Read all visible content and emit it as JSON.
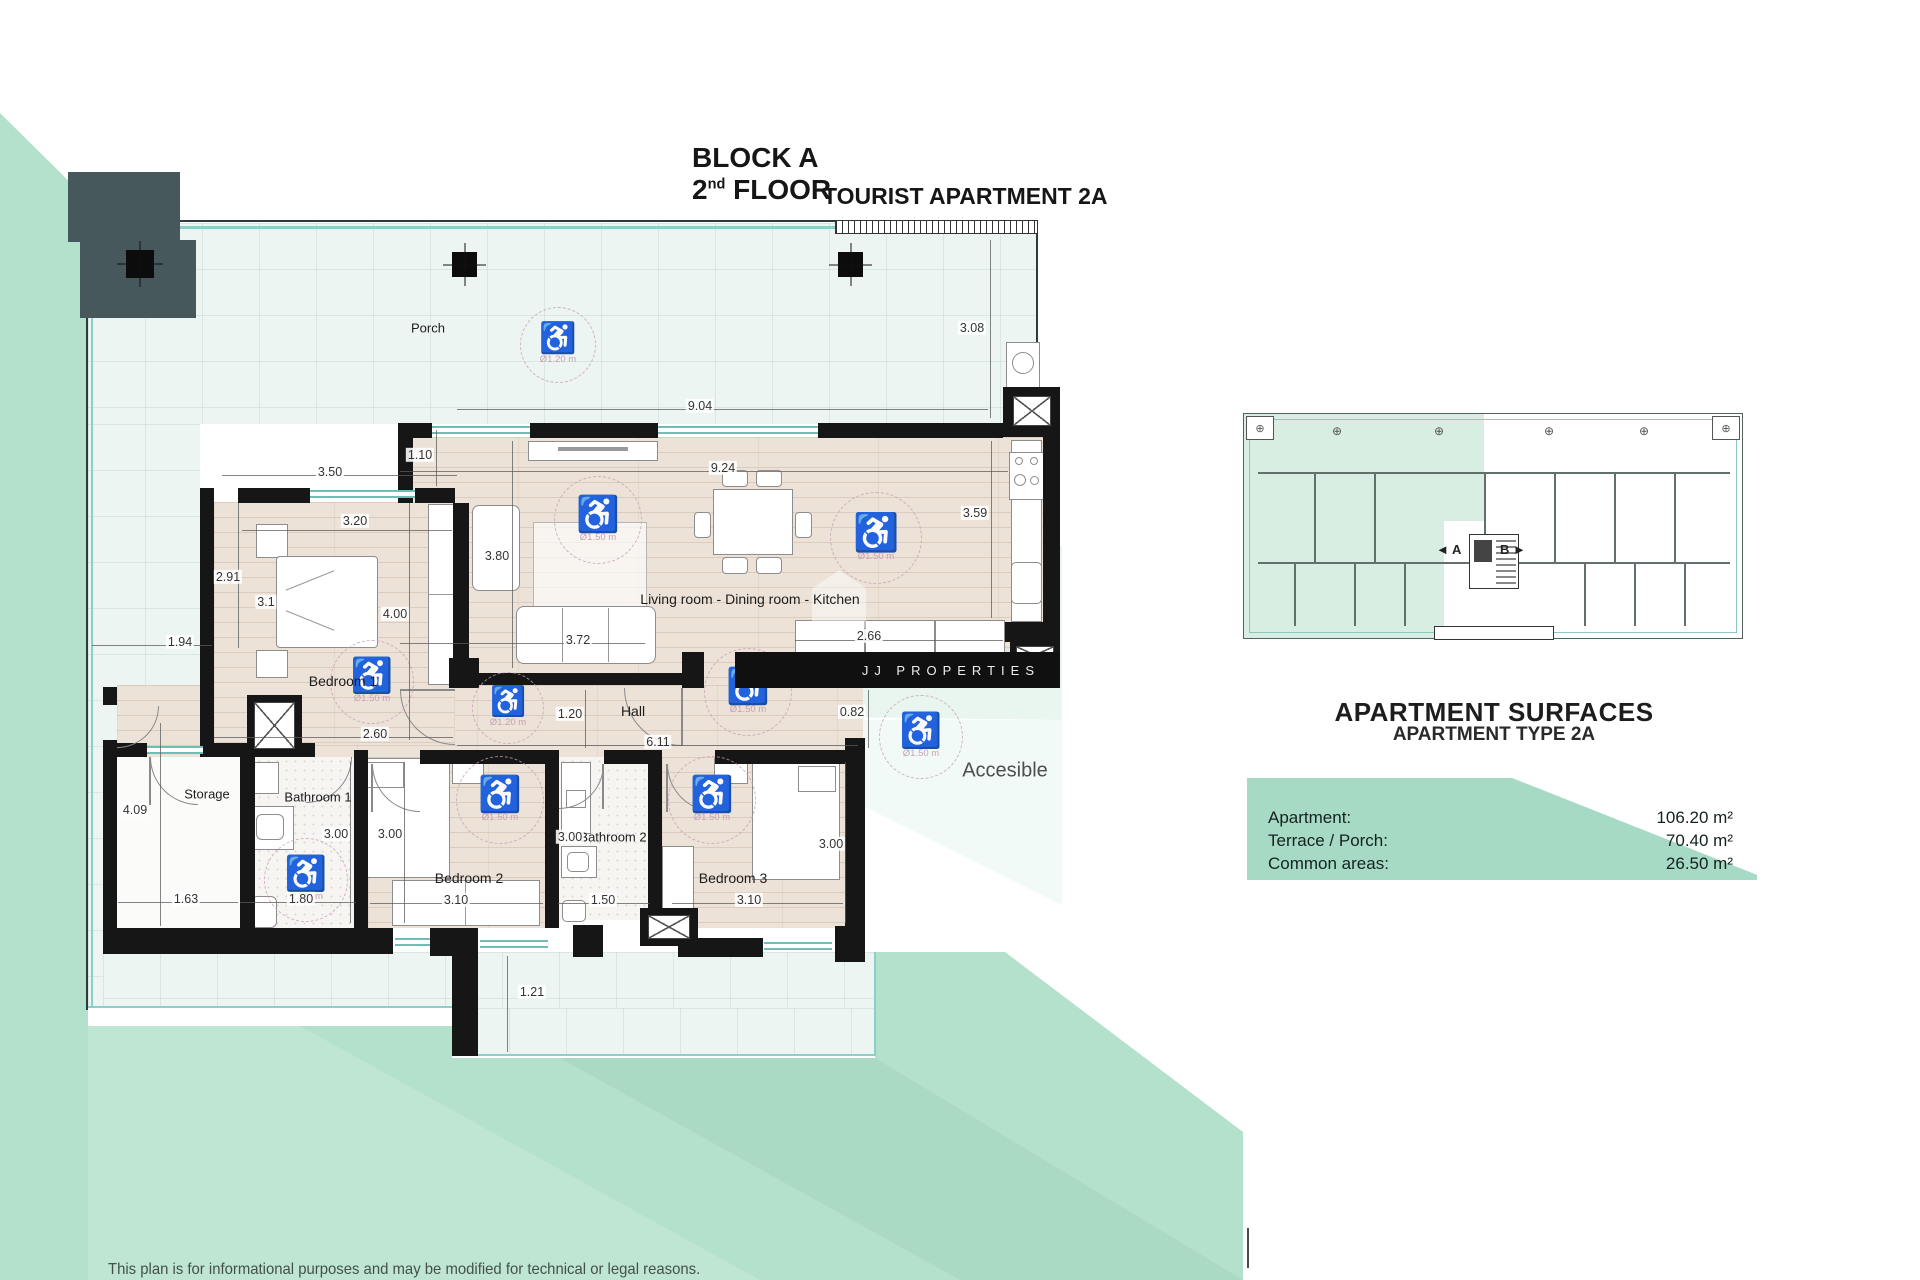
{
  "header": {
    "block_label": "BLOCK A",
    "floor_number": "2",
    "floor_ordinal": "nd",
    "floor_label": "FLOOR",
    "apartment_label": "TOURIST APARTMENT 2A"
  },
  "watermark": {
    "brand": "JJ PROPERTIES"
  },
  "plan": {
    "room_labels": [
      {
        "text": "Porch",
        "x": 428,
        "y": 328,
        "size": 13
      },
      {
        "text": "Living room - Dining room - Kitchen",
        "x": 750,
        "y": 599,
        "size": 14
      },
      {
        "text": "Bedroom 1",
        "x": 343,
        "y": 681,
        "size": 14
      },
      {
        "text": "Hall",
        "x": 633,
        "y": 711,
        "size": 14
      },
      {
        "text": "Storage",
        "x": 207,
        "y": 794,
        "size": 13
      },
      {
        "text": "Bathroom 1",
        "x": 318,
        "y": 797,
        "size": 13
      },
      {
        "text": "Bathroom 2",
        "x": 613,
        "y": 837,
        "size": 13
      },
      {
        "text": "Bedroom 2",
        "x": 469,
        "y": 878,
        "size": 14
      },
      {
        "text": "Bedroom 3",
        "x": 733,
        "y": 878,
        "size": 14
      },
      {
        "text": "Accesible",
        "x": 1005,
        "y": 771,
        "size": 20
      }
    ],
    "dimensions": [
      {
        "value": "3.50",
        "x": 330,
        "y": 472,
        "line": [
          222,
          475,
          457,
          475
        ]
      },
      {
        "value": "1.10",
        "x": 420,
        "y": 455,
        "line": [
          436,
          430,
          436,
          486
        ]
      },
      {
        "value": "9.04",
        "x": 700,
        "y": 406,
        "line": [
          457,
          409,
          988,
          409
        ]
      },
      {
        "value": "3.08",
        "x": 972,
        "y": 328,
        "line": [
          990,
          240,
          990,
          418
        ]
      },
      {
        "value": "3.20",
        "x": 355,
        "y": 521,
        "line": [
          242,
          530,
          452,
          530
        ]
      },
      {
        "value": "9.24",
        "x": 723,
        "y": 468,
        "line": [
          400,
          471,
          1008,
          471
        ]
      },
      {
        "value": "2.91",
        "x": 228,
        "y": 577,
        "line": [
          238,
          503,
          238,
          648
        ]
      },
      {
        "value": "3.80",
        "x": 497,
        "y": 556,
        "line": [
          512,
          441,
          512,
          668
        ]
      },
      {
        "value": "3.59",
        "x": 975,
        "y": 513,
        "line": [
          991,
          441,
          991,
          618
        ]
      },
      {
        "value": "3.1",
        "x": 266,
        "y": 602,
        "line": null
      },
      {
        "value": "4.00",
        "x": 395,
        "y": 614,
        "line": [
          409,
          503,
          409,
          740
        ]
      },
      {
        "value": "1.94",
        "x": 180,
        "y": 642,
        "line": [
          92,
          645,
          212,
          645
        ]
      },
      {
        "value": "3.72",
        "x": 578,
        "y": 640,
        "line": [
          400,
          643,
          645,
          643
        ]
      },
      {
        "value": "2.66",
        "x": 869,
        "y": 636,
        "line": [
          795,
          640,
          1003,
          640
        ]
      },
      {
        "value": "2.60",
        "x": 375,
        "y": 734,
        "line": [
          214,
          737,
          453,
          737
        ]
      },
      {
        "value": "1.20",
        "x": 570,
        "y": 714,
        "line": [
          585,
          690,
          585,
          748
        ]
      },
      {
        "value": "0.82",
        "x": 852,
        "y": 712,
        "line": [
          868,
          690,
          868,
          748
        ]
      },
      {
        "value": "6.11",
        "x": 658,
        "y": 742,
        "line": [
          457,
          745,
          858,
          745
        ]
      },
      {
        "value": "4.09",
        "x": 135,
        "y": 810,
        "line": [
          160,
          723,
          160,
          926
        ]
      },
      {
        "value": "3.00",
        "x": 336,
        "y": 834,
        "line": [
          350,
          762,
          350,
          923
        ]
      },
      {
        "value": "3.00",
        "x": 390,
        "y": 834,
        "line": [
          404,
          762,
          404,
          923
        ]
      },
      {
        "value": "3.00",
        "x": 570,
        "y": 837,
        "line": null
      },
      {
        "value": "3.00",
        "x": 831,
        "y": 844,
        "line": [
          845,
          762,
          845,
          923
        ]
      },
      {
        "value": "1.63",
        "x": 186,
        "y": 899,
        "line": [
          118,
          902,
          238,
          902
        ]
      },
      {
        "value": "1.80",
        "x": 301,
        "y": 899,
        "line": [
          240,
          902,
          356,
          902
        ]
      },
      {
        "value": "3.10",
        "x": 456,
        "y": 900,
        "line": [
          370,
          903,
          543,
          903
        ]
      },
      {
        "value": "1.50",
        "x": 603,
        "y": 900,
        "line": [
          558,
          903,
          650,
          903
        ]
      },
      {
        "value": "3.10",
        "x": 749,
        "y": 900,
        "line": [
          672,
          903,
          843,
          903
        ]
      },
      {
        "value": "1.21",
        "x": 532,
        "y": 992,
        "line": [
          507,
          956,
          507,
          1052
        ]
      }
    ],
    "access_circles": [
      {
        "label": "Ø1.20 m",
        "x": 558,
        "y": 345,
        "r": 38
      },
      {
        "label": "Ø1.50 m",
        "x": 598,
        "y": 520,
        "r": 44
      },
      {
        "label": "Ø1.50 m",
        "x": 876,
        "y": 538,
        "r": 46
      },
      {
        "label": "Ø1.20 m",
        "x": 508,
        "y": 708,
        "r": 36
      },
      {
        "label": "Ø1.50 m",
        "x": 748,
        "y": 692,
        "r": 44
      },
      {
        "label": "Ø1.50 m",
        "x": 372,
        "y": 682,
        "r": 42
      },
      {
        "label": "Ø1.50m",
        "x": 306,
        "y": 880,
        "r": 42
      },
      {
        "label": "Ø1.50 m",
        "x": 500,
        "y": 800,
        "r": 44
      },
      {
        "label": "Ø1.50 m",
        "x": 712,
        "y": 800,
        "r": 44
      },
      {
        "label": "Ø1.50 m",
        "x": 921,
        "y": 737,
        "r": 42
      }
    ]
  },
  "overview": {
    "unit_a": "A",
    "unit_b": "B",
    "unit_a_arrow": "◄",
    "unit_b_arrow": "►",
    "corner_marker": "⊕"
  },
  "surfaces": {
    "title": "APARTMENT SURFACES",
    "subtitle": "APARTMENT TYPE 2A",
    "rows": [
      {
        "label": "Apartment:",
        "value": "106.20 m²"
      },
      {
        "label": "Terrace / Porch:",
        "value": "70.40 m²"
      },
      {
        "label": "Common areas:",
        "value": "26.50 m²"
      }
    ]
  },
  "footer": {
    "disclaimer": "This plan is for informational purposes and may be modified for technical or legal reasons."
  },
  "colors": {
    "mint": "#b3e1cb",
    "surface_band": "#a6dac4",
    "overview_unit": "#d8eee3",
    "wall": "#161616",
    "accessibility_pink": "#c79fb6",
    "window_teal": "#8ccfc7"
  }
}
